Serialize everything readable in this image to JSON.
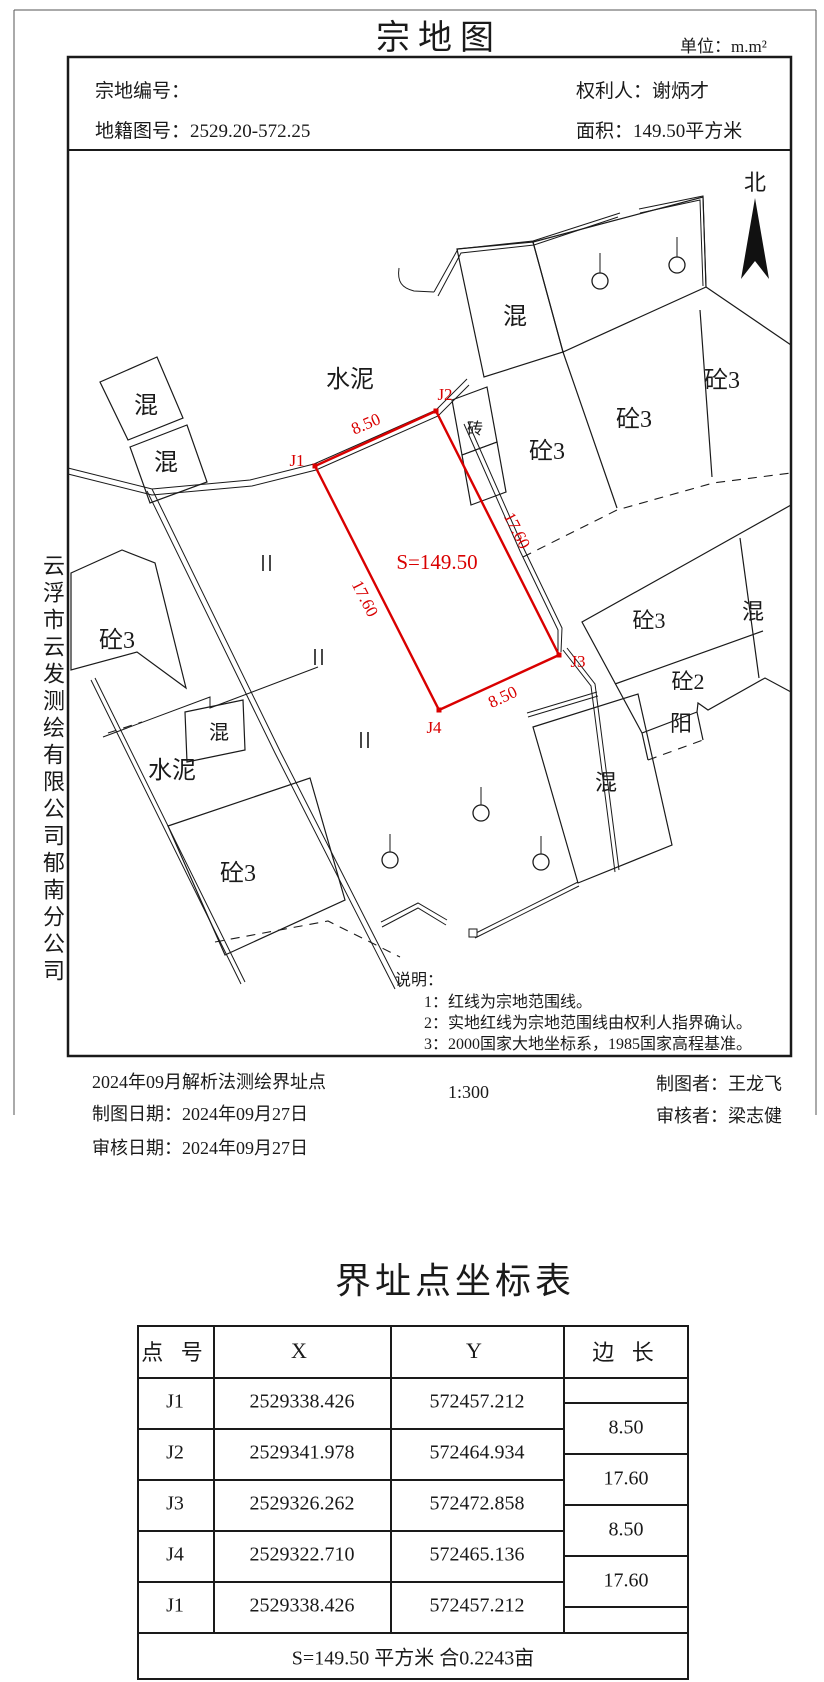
{
  "sheet": {
    "title": "宗地图",
    "unit": "单位：m.m²"
  },
  "header": {
    "parcel_no": "宗地编号：",
    "cadastral_no": "地籍图号：2529.20-572.25",
    "owner": "权利人：谢炳才",
    "area": "面积：149.50平方米"
  },
  "company": "云浮市云发测绘有限公司郁南分公司",
  "map": {
    "north_label": "北",
    "area_label": "S=149.50",
    "points": {
      "j1": "J1",
      "j2": "J2",
      "j3": "J3",
      "j4": "J4"
    },
    "dims": {
      "top": "8.50",
      "left": "17.60",
      "right": "17.60",
      "bottom": "8.50"
    },
    "materials": {
      "hun": "混",
      "tong3": "砼3",
      "tong2": "砼2",
      "shuini": "水泥",
      "zhuan": "砖",
      "yang": "阳"
    },
    "notes": {
      "heading": "说明：",
      "items": [
        "1：红线为宗地范围线。",
        "2：实地红线为宗地范围线由权利人指界确认。",
        "3：2000国家大地坐标系，1985国家高程基准。"
      ]
    }
  },
  "footer": {
    "survey_note": "2024年09月解析法测绘界址点",
    "draw_date": "制图日期：2024年09月27日",
    "review_date": "审核日期：2024年09月27日",
    "scale": "1:300",
    "drafter": "制图者：王龙飞",
    "reviewer": "审核者：梁志健"
  },
  "table": {
    "title": "界址点坐标表",
    "headers": {
      "pt": "点 号",
      "x": "X",
      "y": "Y",
      "edge": "边 长"
    },
    "rows": [
      {
        "pt": "J1",
        "x": "2529338.426",
        "y": "572457.212"
      },
      {
        "pt": "J2",
        "x": "2529341.978",
        "y": "572464.934"
      },
      {
        "pt": "J3",
        "x": "2529326.262",
        "y": "572472.858"
      },
      {
        "pt": "J4",
        "x": "2529322.710",
        "y": "572465.136"
      },
      {
        "pt": "J1",
        "x": "2529338.426",
        "y": "572457.212"
      }
    ],
    "edges": [
      "8.50",
      "17.60",
      "8.50",
      "17.60"
    ],
    "summary": "S=149.50 平方米 合0.2243亩"
  }
}
